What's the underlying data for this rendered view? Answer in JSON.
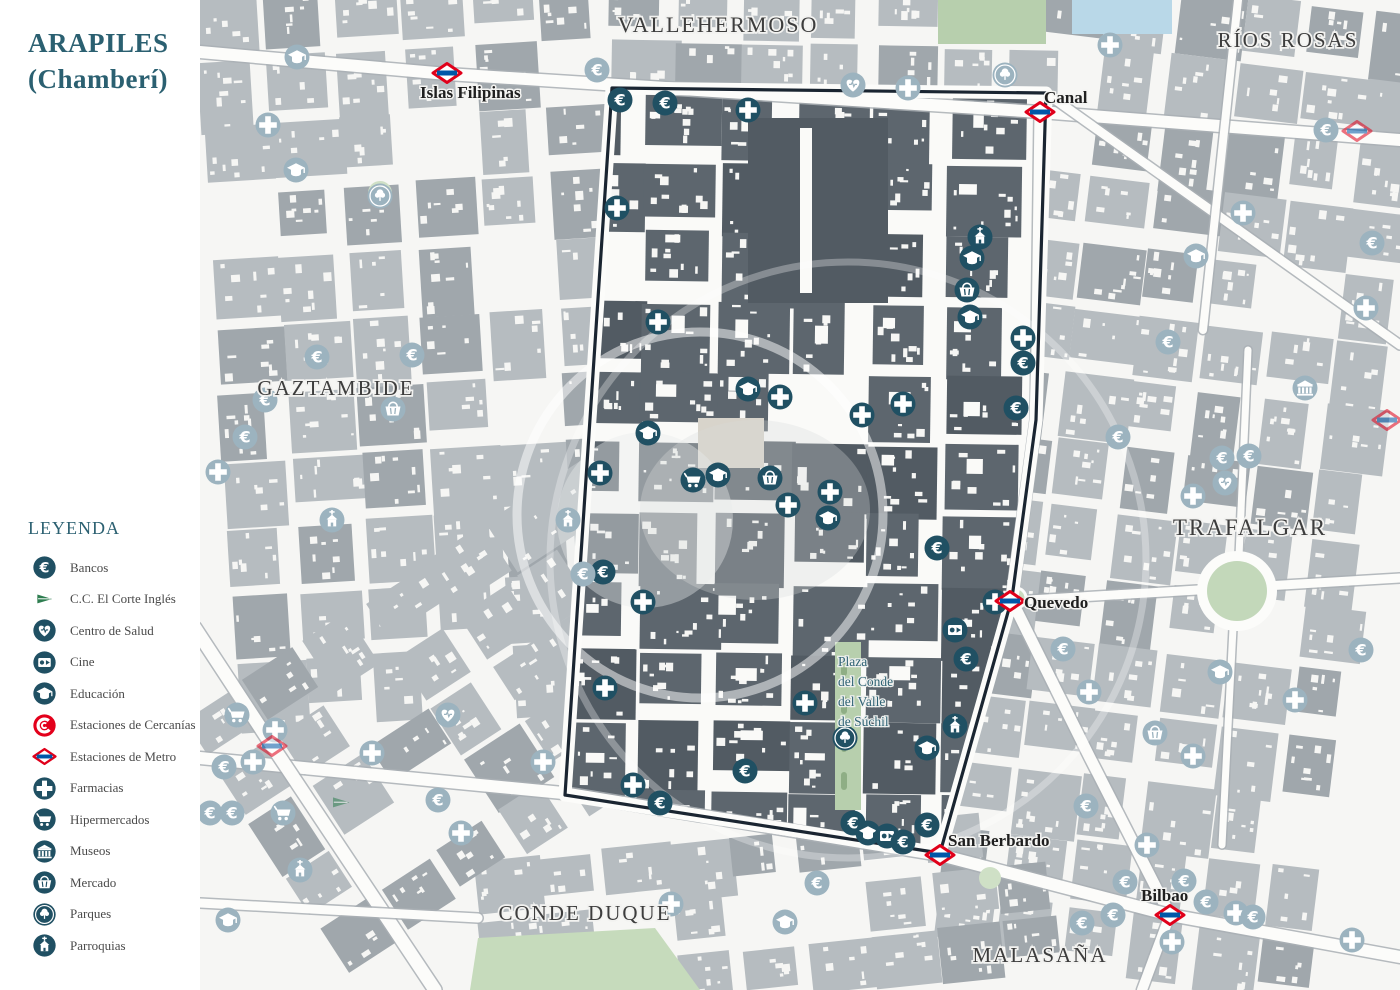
{
  "title": {
    "line1": "ARAPILES",
    "line2": "(Chamberí)"
  },
  "legend": {
    "title": "LEYENDA",
    "items": [
      {
        "icon": "bank",
        "label": "Bancos"
      },
      {
        "icon": "corte",
        "label": "C.C. El Corte Inglés"
      },
      {
        "icon": "salud",
        "label": "Centro de Salud"
      },
      {
        "icon": "cine",
        "label": "Cine"
      },
      {
        "icon": "edu",
        "label": "Educación"
      },
      {
        "icon": "cercanias",
        "label": "Estaciones de Cercanías"
      },
      {
        "icon": "metro",
        "label": "Estaciones de Metro"
      },
      {
        "icon": "pharm",
        "label": "Farmacias"
      },
      {
        "icon": "hiper",
        "label": "Hipermercados"
      },
      {
        "icon": "museo",
        "label": "Museos"
      },
      {
        "icon": "merc",
        "label": "Mercado"
      },
      {
        "icon": "parque",
        "label": "Parques"
      },
      {
        "icon": "parr",
        "label": "Parroquias"
      }
    ]
  },
  "districts": [
    {
      "name": "VALLEHERMOSO",
      "x": 718,
      "y": 32,
      "size": 22
    },
    {
      "name": "RÍOS ROSAS",
      "x": 1288,
      "y": 47,
      "size": 21
    },
    {
      "name": "GAZTAMBIDE",
      "x": 336,
      "y": 395,
      "size": 21
    },
    {
      "name": "TRAFALGAR",
      "x": 1250,
      "y": 535,
      "size": 23
    },
    {
      "name": "CONDE DUQUE",
      "x": 585,
      "y": 920,
      "size": 21
    },
    {
      "name": "MALASAÑA",
      "x": 1040,
      "y": 962,
      "size": 21
    }
  ],
  "metro_stations": [
    {
      "name": "Islas Filipinas",
      "x": 447,
      "y": 73,
      "lx": 420,
      "ly": 98
    },
    {
      "name": "Canal",
      "x": 1040,
      "y": 112,
      "lx": 1044,
      "ly": 103
    },
    {
      "name": "Quevedo",
      "x": 1010,
      "y": 601,
      "lx": 1024,
      "ly": 608
    },
    {
      "name": "San Berbardo",
      "x": 940,
      "y": 855,
      "lx": 948,
      "ly": 846
    },
    {
      "name": "Bilbao",
      "x": 1170,
      "y": 915,
      "lx": 1141,
      "ly": 901
    },
    {
      "name": "",
      "x": 272,
      "y": 746,
      "lx": 0,
      "ly": 0
    },
    {
      "name": "",
      "x": 1357,
      "y": 131,
      "lx": 0,
      "ly": 0
    },
    {
      "name": "",
      "x": 1387,
      "y": 420,
      "lx": 0,
      "ly": 0
    }
  ],
  "plaza_label": {
    "x": 838,
    "lines": [
      "Plaza",
      "del Conde",
      "del Valle",
      "de Súchil"
    ],
    "y0": 666,
    "dy": 20
  },
  "colors": {
    "accent": "#205063",
    "faded": "#9cb3bf",
    "title_teal": "#2b6071",
    "metro_red": "#e0001a",
    "metro_blue": "#0057a8",
    "cercanias_red": "#e3001b",
    "corte_green": "#2e7d50",
    "boundary": "#1a2531",
    "building_in": "#5d666e",
    "building_in2": "#525b63",
    "building_out": "#b6bcc0",
    "building_out2": "#a0a7ac",
    "street": "#fcfcfa",
    "park_green": "#b7cfad",
    "water_blue": "#b9d8e8"
  },
  "map": {
    "pois": [
      {
        "t": "bank",
        "x": 620,
        "y": 100,
        "f": 0
      },
      {
        "t": "bank",
        "x": 665,
        "y": 103,
        "f": 0
      },
      {
        "t": "pharm",
        "x": 748,
        "y": 110,
        "f": 0
      },
      {
        "t": "pharm",
        "x": 617,
        "y": 208,
        "f": 0
      },
      {
        "t": "parr",
        "x": 980,
        "y": 237,
        "f": 0
      },
      {
        "t": "edu",
        "x": 972,
        "y": 258,
        "f": 0
      },
      {
        "t": "merc",
        "x": 967,
        "y": 290,
        "f": 0
      },
      {
        "t": "edu",
        "x": 970,
        "y": 317,
        "f": 0
      },
      {
        "t": "pharm",
        "x": 658,
        "y": 322,
        "f": 0
      },
      {
        "t": "pharm",
        "x": 1023,
        "y": 338,
        "f": 0
      },
      {
        "t": "bank",
        "x": 1023,
        "y": 363,
        "f": 0
      },
      {
        "t": "edu",
        "x": 748,
        "y": 389,
        "f": 0
      },
      {
        "t": "pharm",
        "x": 780,
        "y": 397,
        "f": 0
      },
      {
        "t": "pharm",
        "x": 903,
        "y": 404,
        "f": 0
      },
      {
        "t": "bank",
        "x": 1016,
        "y": 408,
        "f": 0
      },
      {
        "t": "pharm",
        "x": 862,
        "y": 415,
        "f": 0
      },
      {
        "t": "edu",
        "x": 648,
        "y": 433,
        "f": 0
      },
      {
        "t": "pharm",
        "x": 600,
        "y": 473,
        "f": 0
      },
      {
        "t": "edu",
        "x": 718,
        "y": 475,
        "f": 0
      },
      {
        "t": "hiper",
        "x": 693,
        "y": 480,
        "f": 0
      },
      {
        "t": "merc",
        "x": 770,
        "y": 478,
        "f": 0
      },
      {
        "t": "pharm",
        "x": 830,
        "y": 492,
        "f": 0
      },
      {
        "t": "pharm",
        "x": 788,
        "y": 505,
        "f": 0
      },
      {
        "t": "edu",
        "x": 828,
        "y": 518,
        "f": 0
      },
      {
        "t": "bank",
        "x": 937,
        "y": 548,
        "f": 0
      },
      {
        "t": "bank",
        "x": 603,
        "y": 572,
        "f": 0
      },
      {
        "t": "pharm",
        "x": 643,
        "y": 602,
        "f": 0
      },
      {
        "t": "pharm",
        "x": 995,
        "y": 602,
        "f": 0
      },
      {
        "t": "cine",
        "x": 955,
        "y": 630,
        "f": 0
      },
      {
        "t": "bank",
        "x": 966,
        "y": 659,
        "f": 0
      },
      {
        "t": "pharm",
        "x": 605,
        "y": 688,
        "f": 0
      },
      {
        "t": "pharm",
        "x": 805,
        "y": 703,
        "f": 0
      },
      {
        "t": "parr",
        "x": 955,
        "y": 726,
        "f": 0
      },
      {
        "t": "parque",
        "x": 845,
        "y": 738,
        "f": 0
      },
      {
        "t": "edu",
        "x": 927,
        "y": 748,
        "f": 0
      },
      {
        "t": "bank",
        "x": 745,
        "y": 771,
        "f": 0
      },
      {
        "t": "pharm",
        "x": 633,
        "y": 785,
        "f": 0
      },
      {
        "t": "bank",
        "x": 660,
        "y": 803,
        "f": 0
      },
      {
        "t": "bank",
        "x": 853,
        "y": 823,
        "f": 0
      },
      {
        "t": "bank",
        "x": 927,
        "y": 825,
        "f": 0
      },
      {
        "t": "edu",
        "x": 868,
        "y": 833,
        "f": 0
      },
      {
        "t": "cine",
        "x": 887,
        "y": 836,
        "f": 0
      },
      {
        "t": "bank",
        "x": 903,
        "y": 842,
        "f": 0
      },
      {
        "t": "edu",
        "x": 297,
        "y": 57,
        "f": 1
      },
      {
        "t": "bank",
        "x": 597,
        "y": 70,
        "f": 1
      },
      {
        "t": "parque",
        "x": 1005,
        "y": 75,
        "f": 1
      },
      {
        "t": "salud",
        "x": 853,
        "y": 85,
        "f": 1
      },
      {
        "t": "pharm",
        "x": 908,
        "y": 88,
        "f": 1
      },
      {
        "t": "pharm",
        "x": 1110,
        "y": 45,
        "f": 1
      },
      {
        "t": "bank",
        "x": 1326,
        "y": 130,
        "f": 1
      },
      {
        "t": "pharm",
        "x": 268,
        "y": 125,
        "f": 1
      },
      {
        "t": "edu",
        "x": 296,
        "y": 170,
        "f": 1
      },
      {
        "t": "parque",
        "x": 380,
        "y": 196,
        "f": 1
      },
      {
        "t": "pharm",
        "x": 1243,
        "y": 213,
        "f": 1
      },
      {
        "t": "edu",
        "x": 1196,
        "y": 256,
        "f": 1
      },
      {
        "t": "pharm",
        "x": 1366,
        "y": 308,
        "f": 1
      },
      {
        "t": "bank",
        "x": 1372,
        "y": 243,
        "f": 1
      },
      {
        "t": "bank",
        "x": 1168,
        "y": 342,
        "f": 1
      },
      {
        "t": "bank",
        "x": 317,
        "y": 357,
        "f": 1
      },
      {
        "t": "bank",
        "x": 412,
        "y": 355,
        "f": 1
      },
      {
        "t": "museo",
        "x": 1305,
        "y": 388,
        "f": 1
      },
      {
        "t": "bank",
        "x": 265,
        "y": 400,
        "f": 1
      },
      {
        "t": "merc",
        "x": 393,
        "y": 409,
        "f": 1
      },
      {
        "t": "bank",
        "x": 245,
        "y": 437,
        "f": 1
      },
      {
        "t": "bank",
        "x": 1118,
        "y": 437,
        "f": 1
      },
      {
        "t": "bank",
        "x": 1222,
        "y": 458,
        "f": 1
      },
      {
        "t": "bank",
        "x": 1249,
        "y": 456,
        "f": 1
      },
      {
        "t": "pharm",
        "x": 218,
        "y": 472,
        "f": 1
      },
      {
        "t": "salud",
        "x": 1225,
        "y": 483,
        "f": 1
      },
      {
        "t": "pharm",
        "x": 1193,
        "y": 496,
        "f": 1
      },
      {
        "t": "parr",
        "x": 332,
        "y": 520,
        "f": 1
      },
      {
        "t": "parr",
        "x": 568,
        "y": 520,
        "f": 1
      },
      {
        "t": "bank",
        "x": 583,
        "y": 574,
        "f": 1
      },
      {
        "t": "bank",
        "x": 1063,
        "y": 649,
        "f": 1
      },
      {
        "t": "bank",
        "x": 1361,
        "y": 650,
        "f": 1
      },
      {
        "t": "edu",
        "x": 1220,
        "y": 672,
        "f": 1
      },
      {
        "t": "pharm",
        "x": 1089,
        "y": 692,
        "f": 1
      },
      {
        "t": "pharm",
        "x": 1295,
        "y": 700,
        "f": 1
      },
      {
        "t": "hiper",
        "x": 237,
        "y": 715,
        "f": 1
      },
      {
        "t": "salud",
        "x": 448,
        "y": 715,
        "f": 1
      },
      {
        "t": "pharm",
        "x": 275,
        "y": 730,
        "f": 1
      },
      {
        "t": "merc",
        "x": 1155,
        "y": 733,
        "f": 1
      },
      {
        "t": "pharm",
        "x": 253,
        "y": 762,
        "f": 1
      },
      {
        "t": "pharm",
        "x": 372,
        "y": 753,
        "f": 1
      },
      {
        "t": "pharm",
        "x": 543,
        "y": 762,
        "f": 1
      },
      {
        "t": "bank",
        "x": 224,
        "y": 767,
        "f": 1
      },
      {
        "t": "pharm",
        "x": 1193,
        "y": 756,
        "f": 1
      },
      {
        "t": "bank",
        "x": 438,
        "y": 800,
        "f": 1
      },
      {
        "t": "corte",
        "x": 341,
        "y": 803,
        "f": 1
      },
      {
        "t": "bank",
        "x": 210,
        "y": 813,
        "f": 1
      },
      {
        "t": "bank",
        "x": 232,
        "y": 813,
        "f": 1
      },
      {
        "t": "hiper",
        "x": 283,
        "y": 813,
        "f": 1
      },
      {
        "t": "bank",
        "x": 1086,
        "y": 806,
        "f": 1
      },
      {
        "t": "pharm",
        "x": 461,
        "y": 833,
        "f": 1
      },
      {
        "t": "pharm",
        "x": 1147,
        "y": 845,
        "f": 1
      },
      {
        "t": "parr",
        "x": 300,
        "y": 870,
        "f": 1
      },
      {
        "t": "bank",
        "x": 817,
        "y": 883,
        "f": 1
      },
      {
        "t": "bank",
        "x": 1125,
        "y": 882,
        "f": 1
      },
      {
        "t": "bank",
        "x": 1184,
        "y": 881,
        "f": 1
      },
      {
        "t": "pharm",
        "x": 671,
        "y": 904,
        "f": 1
      },
      {
        "t": "bank",
        "x": 1206,
        "y": 902,
        "f": 1
      },
      {
        "t": "bank",
        "x": 1113,
        "y": 915,
        "f": 1
      },
      {
        "t": "pharm",
        "x": 1236,
        "y": 913,
        "f": 1
      },
      {
        "t": "bank",
        "x": 1253,
        "y": 917,
        "f": 1
      },
      {
        "t": "edu",
        "x": 228,
        "y": 920,
        "f": 1
      },
      {
        "t": "edu",
        "x": 785,
        "y": 922,
        "f": 1
      },
      {
        "t": "pharm",
        "x": 1172,
        "y": 942,
        "f": 1
      },
      {
        "t": "pharm",
        "x": 1352,
        "y": 940,
        "f": 1
      },
      {
        "t": "bank",
        "x": 1082,
        "y": 923,
        "f": 1
      }
    ]
  }
}
